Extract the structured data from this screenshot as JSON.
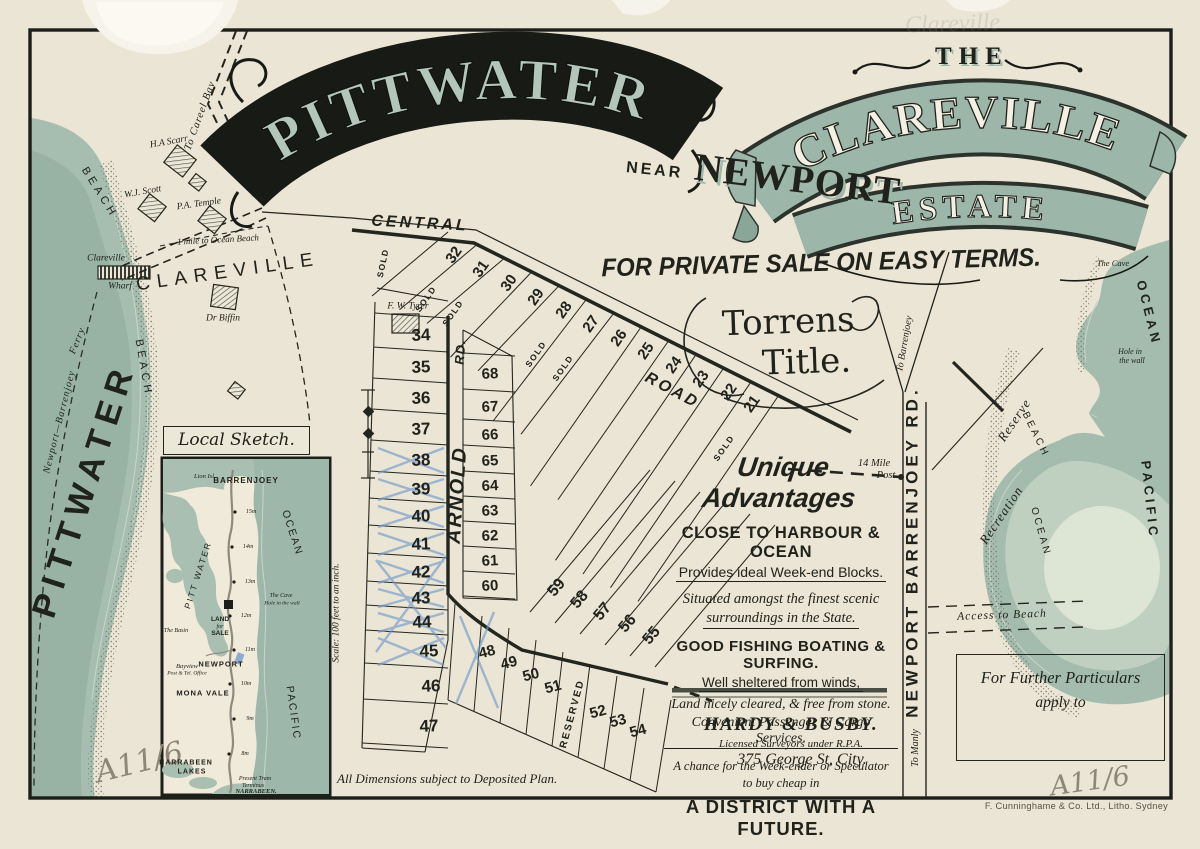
{
  "poster": {
    "title": "PITTWATER",
    "near": "NEAR",
    "newport": "NEWPORT",
    "the": "THE",
    "clareville": "CLAREVILLE",
    "estate": "ESTATE",
    "sale": "FOR PRIVATE SALE ON EASY TERMS.",
    "torrens1": "Torrens",
    "torrens2": "Title.",
    "pencil_top": "Clareville",
    "mark_left": "A11/6",
    "mark_right": "A11/6",
    "litho": "F. Cunninghame & Co. Ltd., Litho. Sydney",
    "dimensions_note": "All Dimensions subject to Deposited Plan."
  },
  "advantages": {
    "lines": [
      "Unique Advantages",
      "CLOSE TO HARBOUR & OCEAN",
      "Provides ideal Week-end Blocks.",
      "Situated amongst the finest scenic",
      "surroundings in the State.",
      "GOOD FISHING BOATING & SURFING.",
      "Well sheltered from winds,",
      "Land nicely cleared, & free from stone.",
      "Convenient Passenger & Cargo Services.",
      "A chance for the Week-ender or Speculator",
      "to buy cheap in",
      "A DISTRICT WITH A FUTURE."
    ]
  },
  "surveyor": {
    "name": "HARDY & BUSBY.",
    "line2": "Licensed Surveyors under R.P.A.",
    "line3": "375 George St, City."
  },
  "particulars": {
    "line1": "For Further Particulars",
    "line2": "apply to"
  },
  "labels": {
    "pittwater": "PITTWATER",
    "beach_upper": "BEACH",
    "beach_lower": "BEACH",
    "ferry1": "Newport—Barrenjoey",
    "ferry2": "Ferry",
    "wharf1": "Clareville",
    "wharf2": "Wharf",
    "clareville_town": "CLAREVILLE",
    "to_careel": "To Careel Bay",
    "mile_beach": "1 mile to Ocean Beach",
    "central": "CENTRAL",
    "road": "ROAD",
    "arnold": "ARNOLD",
    "arnold_rd": "RD.",
    "nbr": "NEWPORT BARRENJOEY RD.",
    "to_manly": "To Manly",
    "to_barrenjoey": "To Barrenjoey",
    "mile_post1": "14 Mile",
    "mile_post2": "Post",
    "recreation": "Recreation",
    "reserve": "Reserve",
    "beach_e": "BEACH",
    "ocean_e": "OCEAN",
    "access": "Access to Beach",
    "ocean_ne": "OCEAN",
    "pacific": "PACIFIC",
    "the_cave": "The Cave",
    "hole1": "Hole in",
    "hole2": "the wall",
    "scale": "Scale: 100 feet to an inch.",
    "sold": "SOLD",
    "reserved": "RESERVED"
  },
  "residents": {
    "scarr": "H.A Scarr",
    "scott": "W.J. Scott",
    "temple": "P.A. Temple",
    "biffin": "Dr Biffin",
    "tyrer": "F. W. Tyrer"
  },
  "lots": {
    "column_a": [
      "34",
      "35",
      "36",
      "37",
      "38",
      "39",
      "40",
      "41",
      "42",
      "43",
      "44",
      "45",
      "46",
      "47"
    ],
    "top_row": [
      "32",
      "31",
      "30",
      "29",
      "28",
      "27",
      "26",
      "25",
      "24",
      "23",
      "22",
      "21"
    ],
    "column_b": [
      "68",
      "67",
      "66",
      "65",
      "64",
      "63",
      "62",
      "61",
      "60"
    ],
    "long_tier": [
      "59",
      "58",
      "57",
      "56",
      "55"
    ],
    "bottom_tier": [
      "48",
      "49",
      "50",
      "51",
      "52",
      "53",
      "54"
    ]
  },
  "inset": {
    "title": "Local Sketch.",
    "labels": {
      "lion": "Lion Isl",
      "barrenjoey": "BARRENJOEY",
      "pittwater": "PITT WATER",
      "ocean": "OCEAN",
      "pacific": "PACIFIC",
      "basin": "The Basin",
      "cave": "The Cave",
      "hole": "Hole in the wall",
      "land": "LAND",
      "for": "for",
      "sale": "SALE",
      "newport": "NEWPORT",
      "bayview": "Bayview",
      "bayview2": "Post & Tel. Office",
      "mona": "MONA VALE",
      "narrabeen": "NARRABEEN",
      "lakes": "LAKES",
      "tram1": "Present Tram",
      "tram2": "Terminus",
      "tram3": "NARRABEEN."
    },
    "mileposts": [
      "15m",
      "14m",
      "13m",
      "12m",
      "11m",
      "10m",
      "9m",
      "8m"
    ]
  }
}
